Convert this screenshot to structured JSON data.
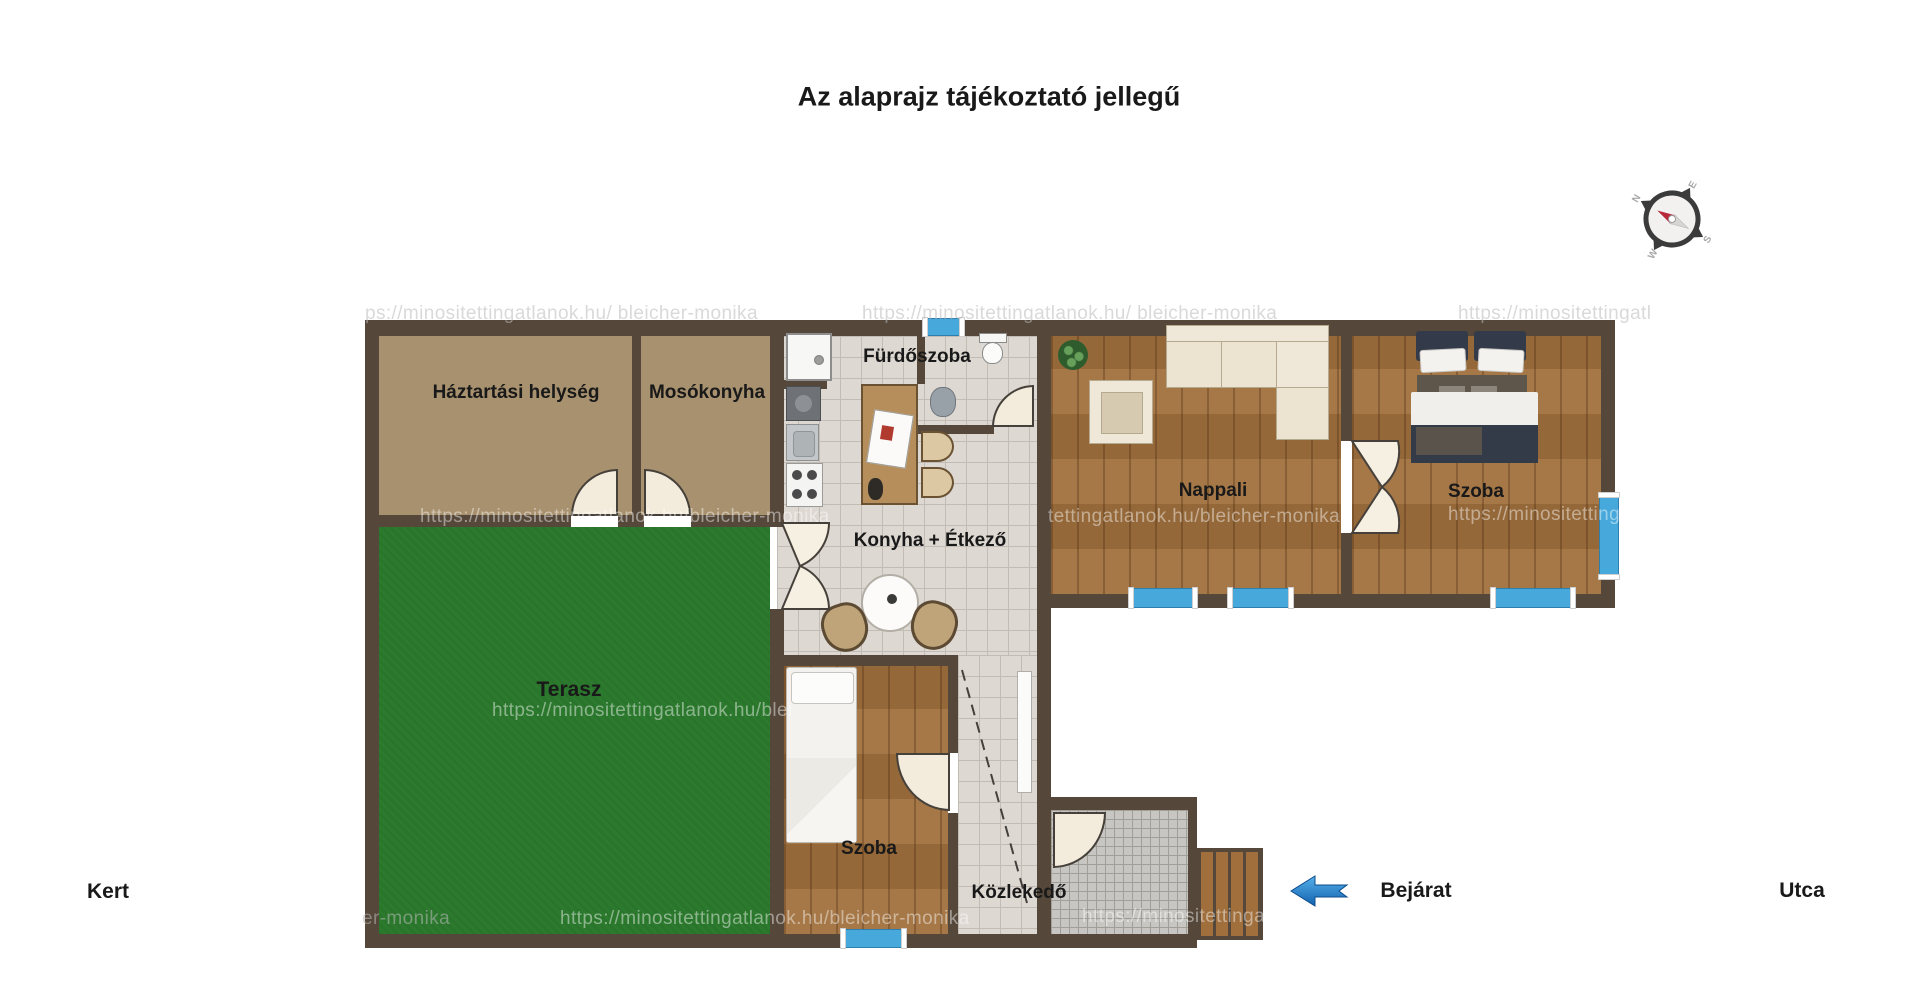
{
  "title": "Az alaprajz tájékoztató jellegű",
  "rooms": {
    "haztartasi": "Háztartási helység",
    "mosokonyha": "Mosókonyha",
    "furdoszoba": "Fürdőszoba",
    "konyha": "Konyha + Étkező",
    "nappali": "Nappali",
    "szoba_right": "Szoba",
    "terasz": "Terasz",
    "szoba_small": "Szoba",
    "kozlekedo": "Közlekedő"
  },
  "outside_labels": {
    "kert": "Kert",
    "bejarat": "Bejárat",
    "utca": "Utca"
  },
  "compass": {
    "n": "N",
    "e": "E",
    "s": "S",
    "w": "W"
  },
  "watermark": {
    "full_url": "https://minositettingatlanok.hu/bleicher-monika",
    "fragments": [
      "ps://minositettingatlanok.hu/ bleicher-monika",
      "https://minositettingatlanok.hu/ bleicher-monika",
      "https://minositettingatl",
      "https://minositettingatlanok.hu/bleicher-monika",
      "tettingatlanok.hu/bleicher-monika",
      "https://minositetting",
      "https://minositettingatlanok.hu/blei",
      "https://minositettingatlanok.hu/bleicher-monika",
      "er-monika",
      "https://minositettingat"
    ]
  },
  "colors": {
    "wall": "#55473a",
    "room_tan": "#a8916e",
    "terrace_green": "#2c7a2e",
    "wood_floor": "#a1713e",
    "tile": "#ddd8d2",
    "entry_tile": "#c7c6c2",
    "window_blue": "#47a9db",
    "arrow_blue": "#1261ae"
  }
}
